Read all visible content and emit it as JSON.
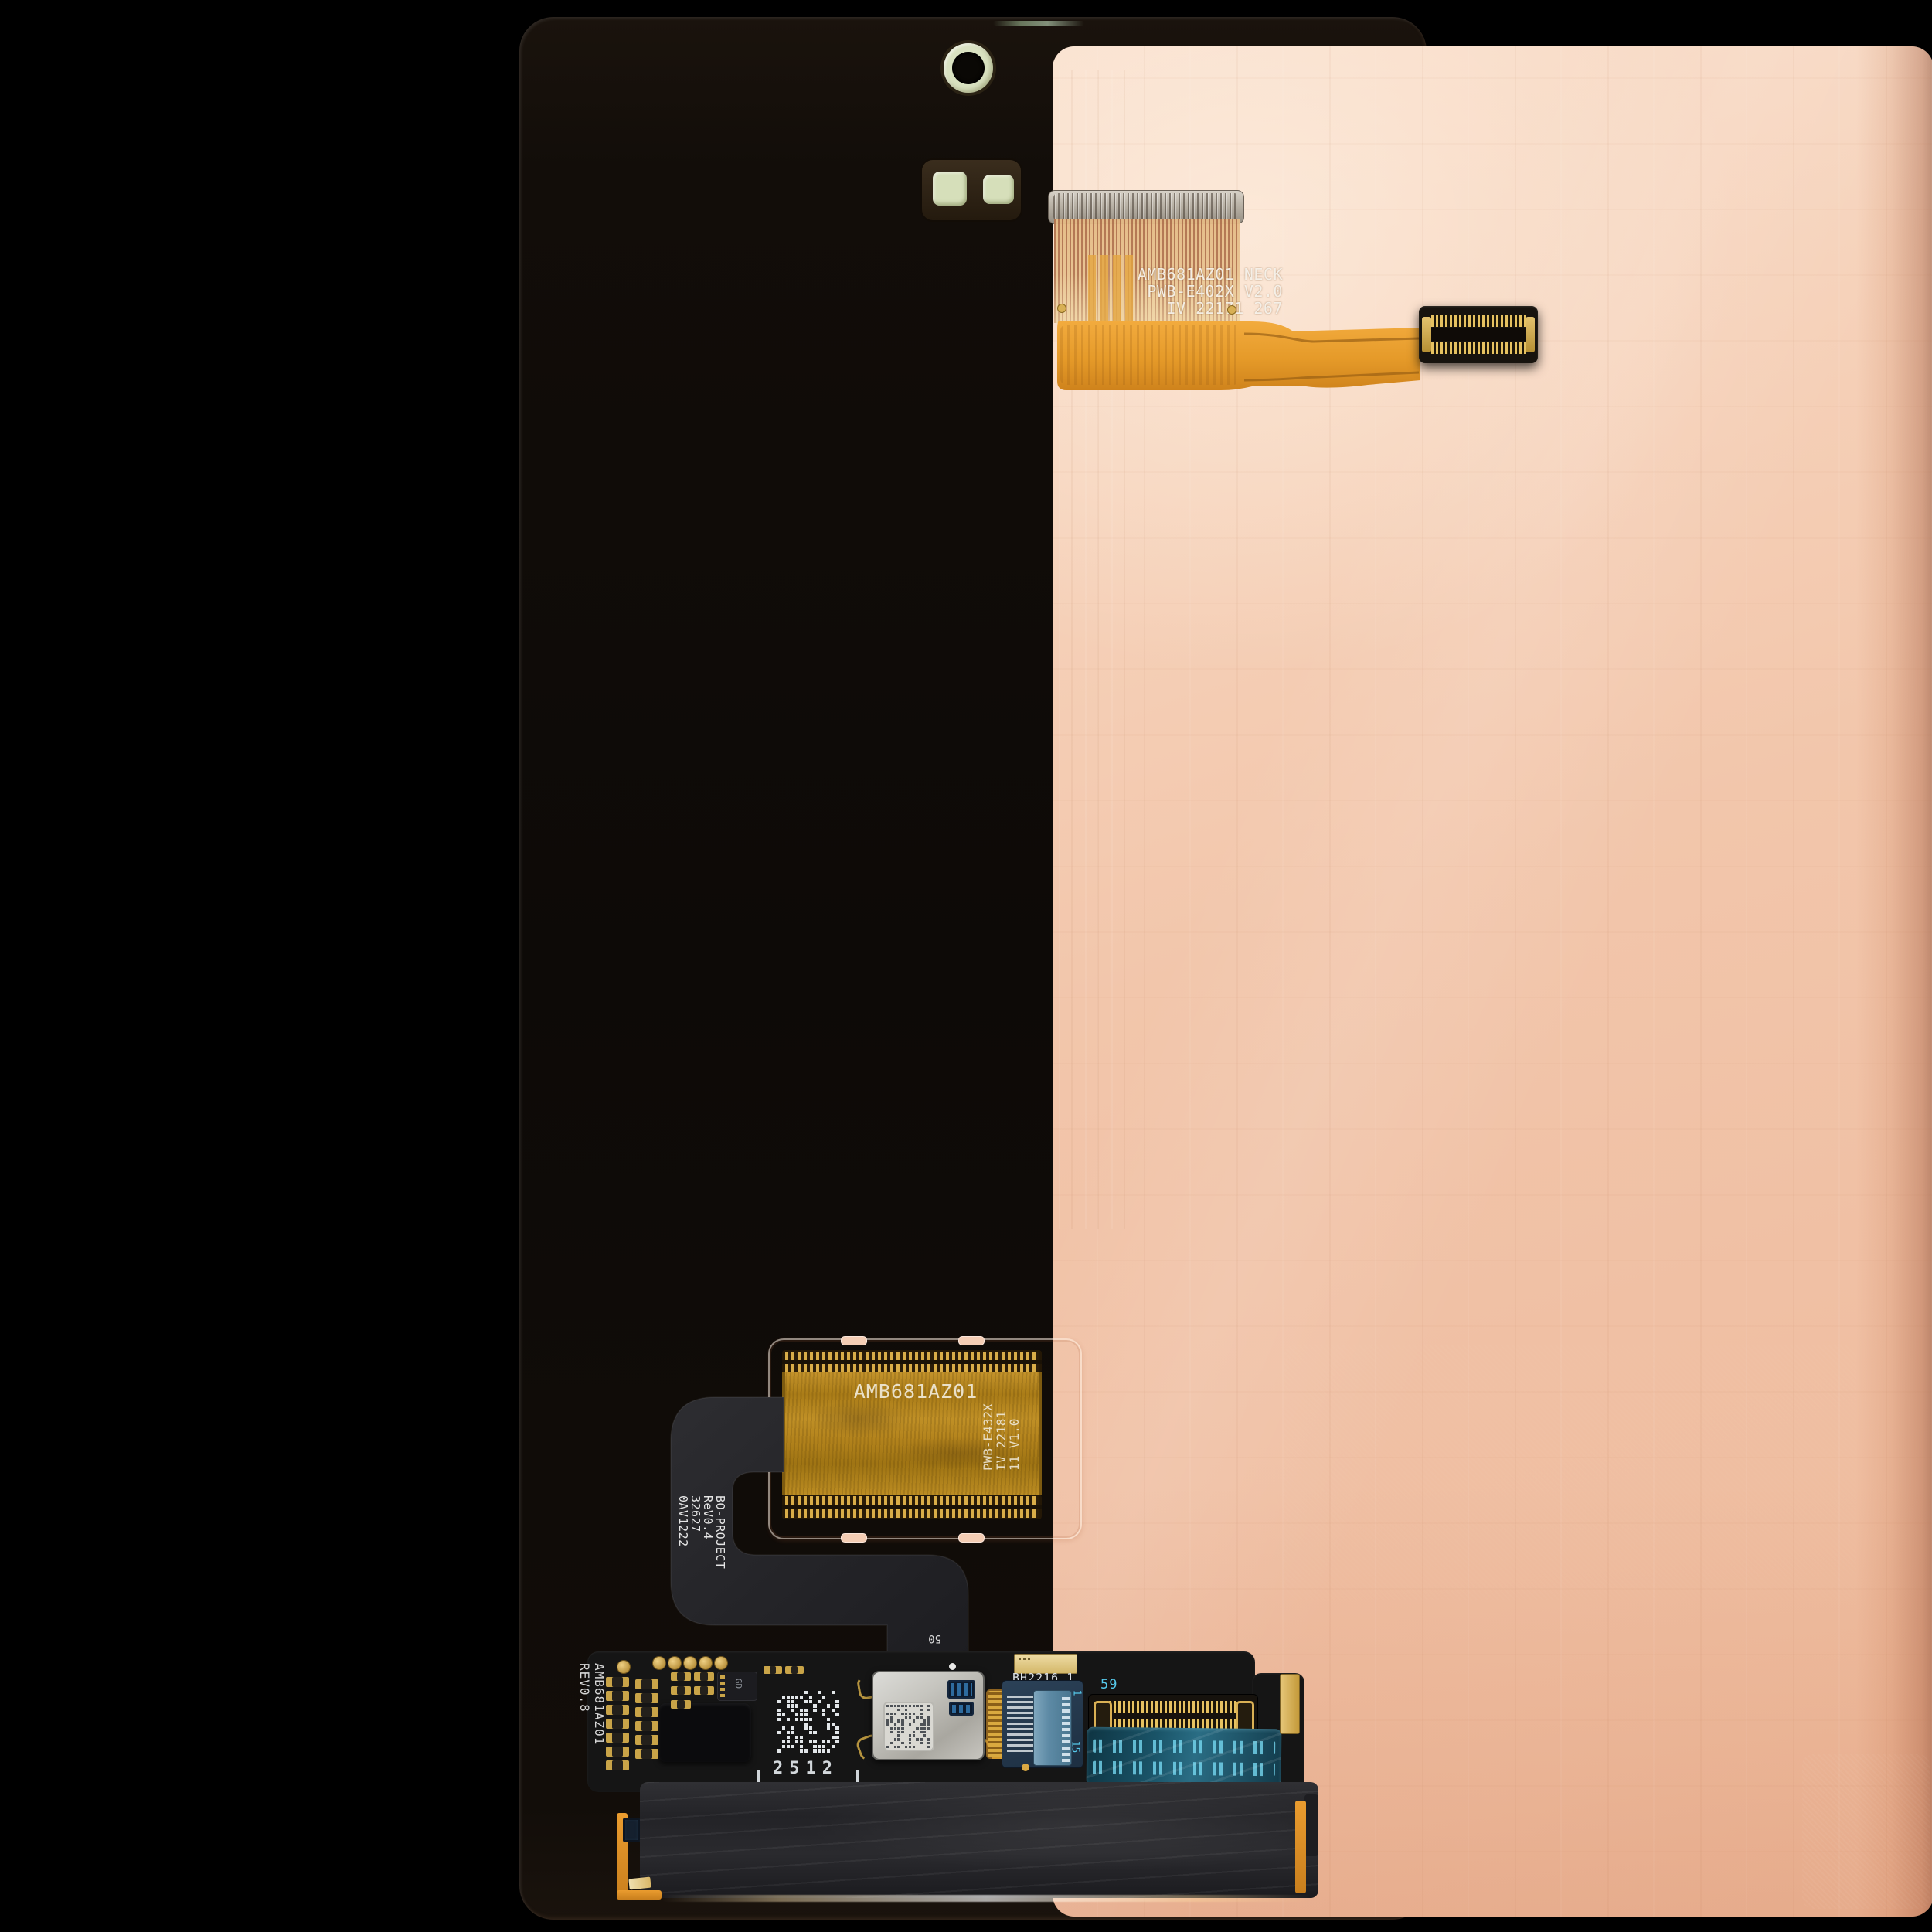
{
  "image": {
    "type": "product-photo",
    "subject": "Smartphone OLED display assembly, rear copper panel with flex cables"
  },
  "colors": {
    "background": "#000000",
    "copper_light": "#f8dcc7",
    "copper_mid": "#f2c5aa",
    "copper_deep": "#ecb697",
    "panel_edge": "#120d09",
    "flex_orange": "#eda233",
    "flex_amber": "#b3831c",
    "gold": "#d2a94a",
    "ribbon_black": "#242428",
    "pcb_black": "#151515",
    "teal_flex": "#1d5569",
    "cyan_text": "#55c8ea",
    "sensor_green": "#d6dfba",
    "silver_module": "#c3c2bc"
  },
  "markings": {
    "top_flex": {
      "line1": "AMB681AZ01 NECK",
      "line2": "PWB-E402X  V2.0",
      "line3": "IV  22171   267"
    },
    "main_flex": {
      "label": "AMB681AZ01",
      "side1": "PWB-E432X",
      "side2": "IV 22181",
      "side3": "11 V1.0"
    },
    "ribbon": {
      "line1": "BO-PROJECT",
      "line2": "ReV0.4",
      "line3": "32627",
      "line4": "0AV1222"
    },
    "pcb": {
      "edge": "AMB681AZ01 REV0.8",
      "ref50": "50",
      "date": "2512",
      "bh": "BH2216  1",
      "ref59": "59",
      "pin_first": "1",
      "pin_last": "15",
      "chip": "GD"
    }
  }
}
